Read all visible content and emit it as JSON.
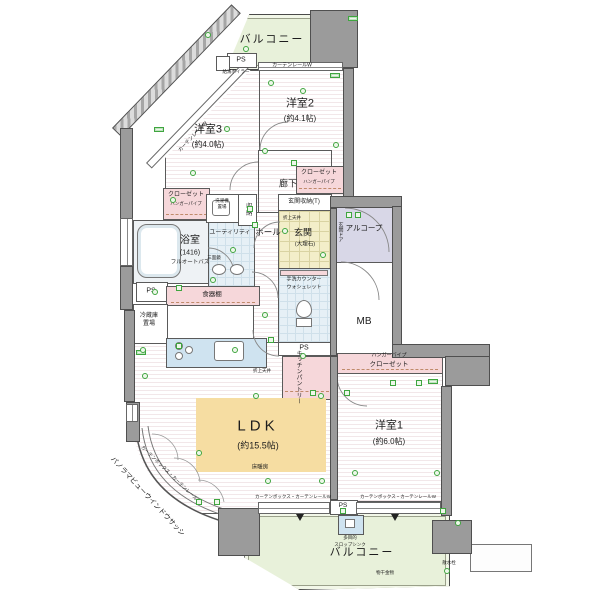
{
  "fp": {
    "ps": "PS",
    "balconyTop": {
      "label": "バルコニー",
      "boiler": "給湯ボイラー"
    },
    "curtainRail": "カーテンレールW",
    "y2": {
      "name": "洋室2",
      "size": "(約4.1帖)"
    },
    "y3": {
      "name": "洋室3",
      "size": "(約4.0帖)"
    },
    "corridor": "廊下",
    "closet": "クローゼット",
    "hanger": "ハンガーパイプ",
    "genkanStorage": "玄関収納(T)",
    "genkan": {
      "name": "玄関",
      "sub": "(大理石)"
    },
    "oriage": "折上天井",
    "alcove": "アルコープ",
    "genkanDoor": "玄関ドア",
    "mb": "MB",
    "toilet": {
      "counter": "手洗カウンター",
      "washlet": "ウォシュレット"
    },
    "pantry": "キッチンパントリー",
    "hall": "ホール",
    "storage": "収納",
    "laundry": {
      "l1": "洗濯機",
      "l2": "置場"
    },
    "utility": "ユーティリティ",
    "mirror": "三面鏡",
    "bath": {
      "name": "浴室",
      "size": "(1416)",
      "type": "フルオートバス"
    },
    "dish": "食器棚",
    "fridge": {
      "l1": "冷蔵庫",
      "l2": "置場"
    },
    "ldk": {
      "name": "LDK",
      "size": "(約15.5帖)",
      "heating": "床暖房"
    },
    "y1": {
      "name": "洋室1",
      "size": "(約6.0帖)"
    },
    "curtainBox": "カーテンボックス・カーテンレールW",
    "panorama": "パノラマビューウインドウサッシ",
    "balconyBottom": {
      "label": "バルコニー",
      "slop1": "多目的",
      "slop2": "スロップシンク",
      "hook": "物干金物",
      "tap": "散水栓"
    },
    "colors": {
      "wall": "#9b9b9b",
      "balcony_green": "#e8f1da",
      "floor_heating_yellow": "#f6dda2",
      "closet_pink": "#f6d7da",
      "alcove_lavender": "#d8d7e7",
      "counter_blue": "#cfe3f0",
      "icon_green": "#3fa53f"
    }
  }
}
